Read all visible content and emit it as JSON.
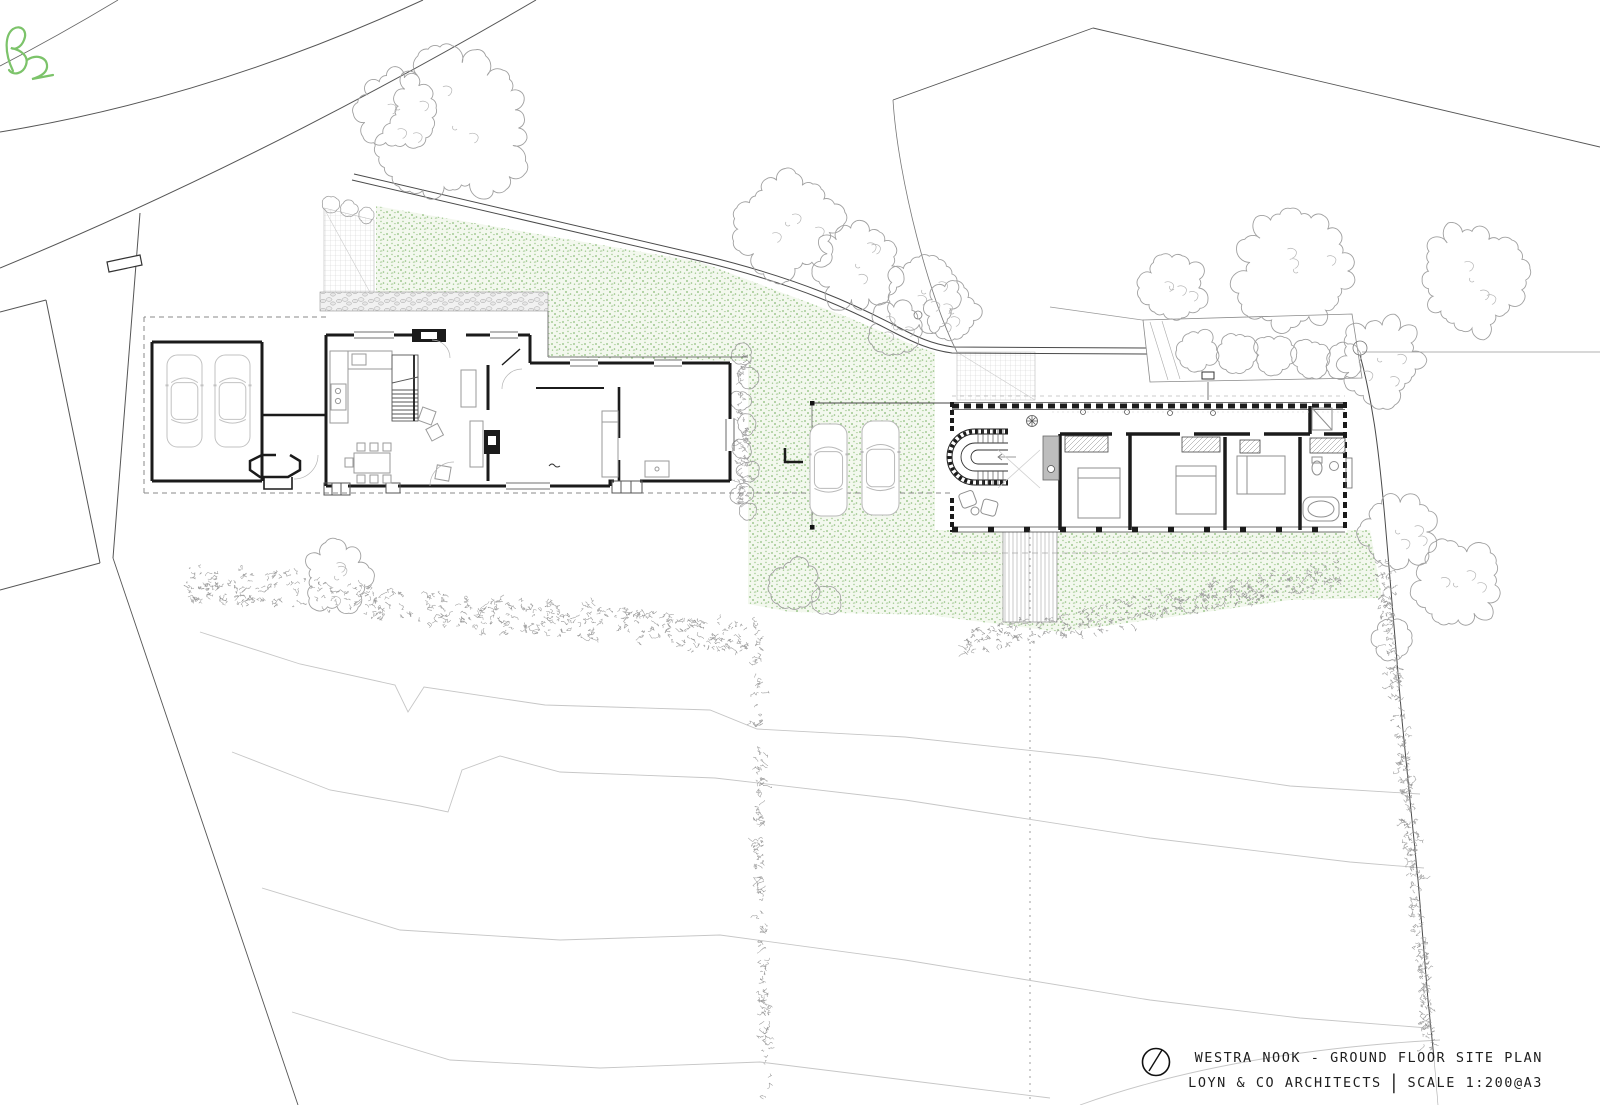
{
  "title_block": {
    "project": "WESTRA NOOK - GROUND FLOOR SITE PLAN",
    "firm": "LOYN & CO ARCHITECTS",
    "divider": "|",
    "scale": "SCALE 1:200@A3"
  },
  "revision_mark": {
    "letter": "B",
    "color": "#7cc36a"
  },
  "palette": {
    "paper": "#ffffff",
    "grass_speckle": "#8fbe7d",
    "wall_black": "#1b1b1b",
    "furniture_gray": "#9a9a9a",
    "boundary_gray": "#4a4a4a",
    "contour_gray": "#c6c6c6",
    "vegetation_gray": "#a0a0a0"
  }
}
